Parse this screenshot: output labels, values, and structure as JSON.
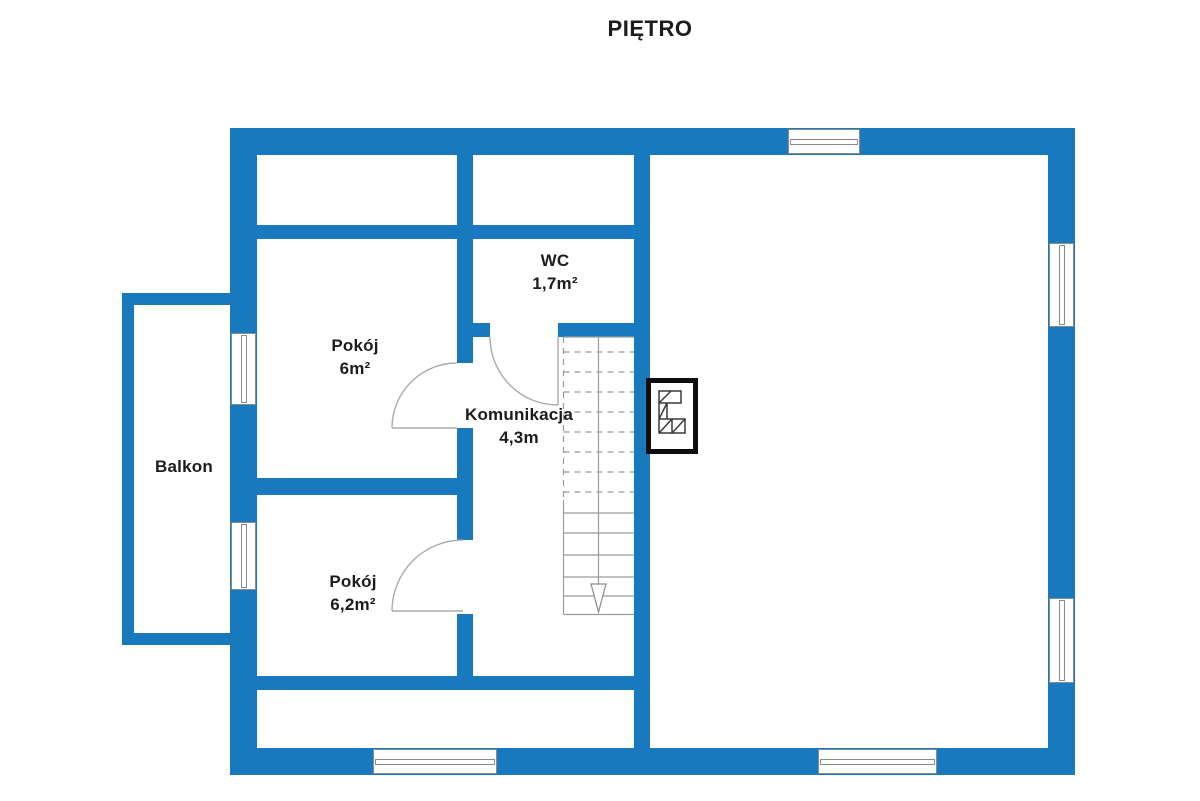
{
  "title": "PIĘTRO",
  "colors": {
    "wall": "#1979bf",
    "line": "#9b9b9b",
    "chimney_border": "#0e0e0e",
    "text": "#1c1c1c"
  },
  "rooms": {
    "wc": {
      "name": "WC",
      "area": "1,7m²"
    },
    "pokoj1": {
      "name": "Pokój",
      "area": "6m²"
    },
    "komunikacja": {
      "name": "Komunikacja",
      "area": "4,3m"
    },
    "pokoj2": {
      "name": "Pokój",
      "area": "6,2m²"
    },
    "balkon": {
      "name": "Balkon",
      "area": ""
    }
  },
  "icons": {
    "chimney": "chimney-flue-icon",
    "stairs_direction": "down-arrow-icon"
  }
}
